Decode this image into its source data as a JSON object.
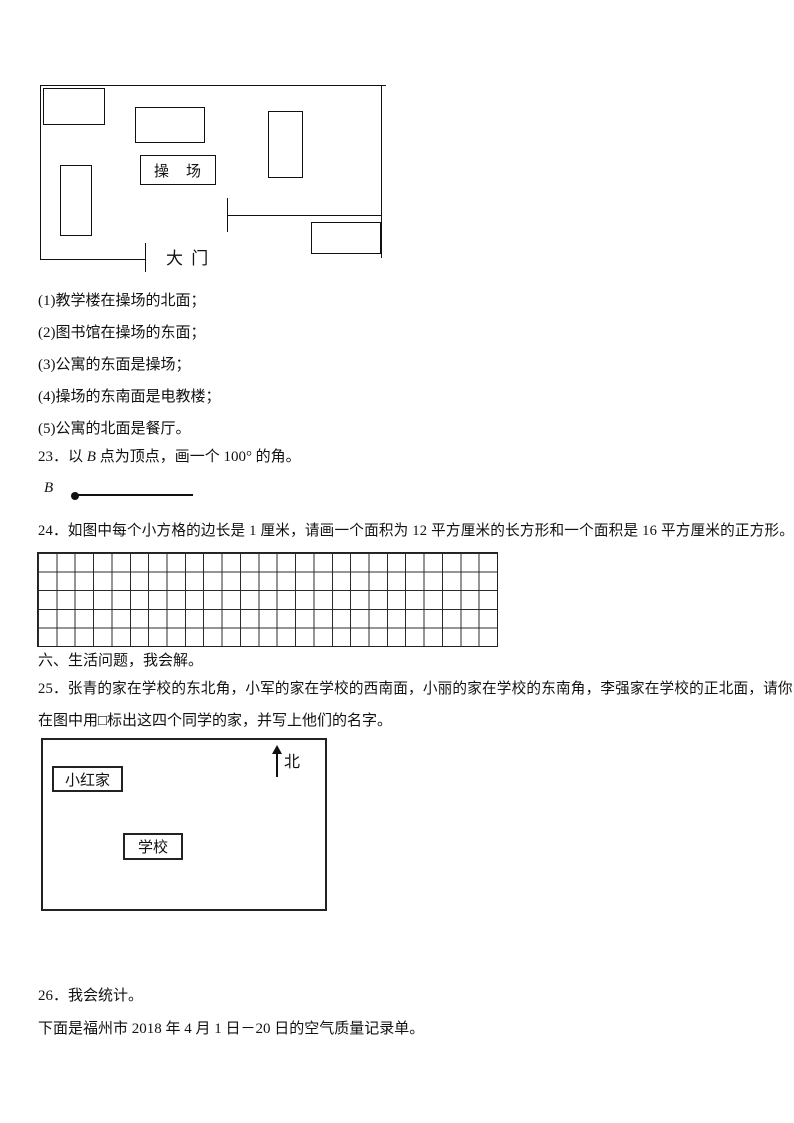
{
  "school_map": {
    "playground_label": "操　场",
    "gate_label": "大 门",
    "building_count": 6
  },
  "statements": [
    "(1)教学楼在操场的北面；",
    "(2)图书馆在操场的东面；",
    "(3)公寓的东面是操场；",
    "(4)操场的东南面是电教楼；",
    "(5)公寓的北面是餐厅。"
  ],
  "q23": {
    "text_prefix": "23．以 ",
    "vertex_label": "B",
    "text_suffix": " 点为顶点，画一个 100° 的角。",
    "ray_point_label": "B"
  },
  "q24": {
    "text": "24．如图中每个小方格的边长是 1 厘米，请画一个面积为 12 平方厘米的长方形和一个面积是 16 平方厘米的正方形。",
    "grid_columns": 25,
    "grid_rows": 5
  },
  "section_six": {
    "heading": "六、生活问题，我会解。"
  },
  "q25": {
    "line1": "25．张青的家在学校的东北角，小军的家在学校的西南面，小丽的家在学校的东南角，李强家在学校的正北面，请你",
    "line2": "在图中用□标出这四个同学的家，并写上他们的名字。",
    "map": {
      "home_label": "小红家",
      "school_label": "学校",
      "north_label": "北"
    }
  },
  "q26": {
    "heading": "26．我会统计。",
    "subtext": "下面是福州市 2018 年 4 月 1 日－20 日的空气质量记录单。"
  }
}
